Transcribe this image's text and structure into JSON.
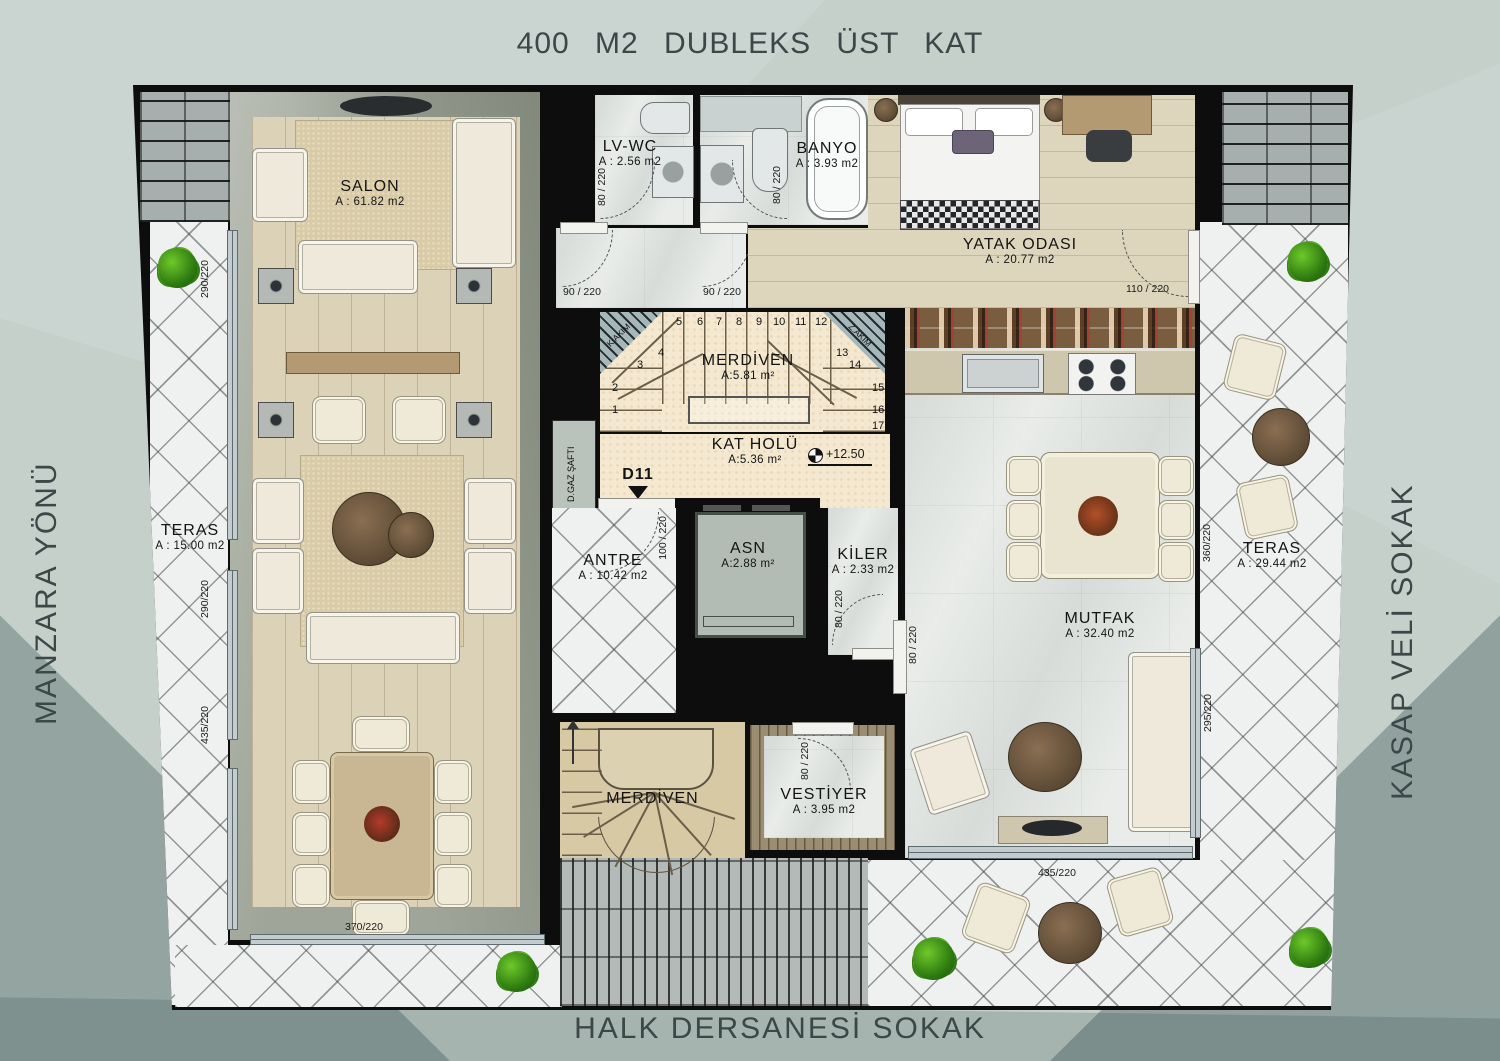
{
  "colors": {
    "wall": "#0d0d0d",
    "background": "#c5d0cb",
    "wood": "#dcd2b8",
    "tile": "#eff1f0",
    "cream": "#f4e9d0",
    "text": "#3c4848"
  },
  "title": "400 M2 DUBLEKS ÜST KAT",
  "streets": {
    "left": "MANZARA YÖNÜ",
    "right": "KASAP VELİ SOKAK",
    "bottom": "HALK DERSANESİ SOKAK"
  },
  "rooms": {
    "salon": {
      "name": "SALON",
      "area": "A : 61.82 m2"
    },
    "lvwc": {
      "name": "LV-WC",
      "area": "A : 2.56 m2"
    },
    "banyo": {
      "name": "BANYO",
      "area": "A : 3.93 m2"
    },
    "yatak_odasi": {
      "name": "YATAK ODASI",
      "area": "A : 20.77 m2"
    },
    "merdiven_ust": {
      "name": "MERDİVEN",
      "area": "A:5.81 m²"
    },
    "kat_holu": {
      "name": "KAT HOLÜ",
      "area": "A:5.36 m²",
      "level": "+12.50"
    },
    "asn": {
      "name": "ASN",
      "area": "A:2.88 m²"
    },
    "antre": {
      "name": "ANTRE",
      "area": "A : 10.42 m2"
    },
    "kiler": {
      "name": "KİLER",
      "area": "A : 2.33 m2"
    },
    "mutfak": {
      "name": "MUTFAK",
      "area": "A : 32.40 m2"
    },
    "teras_bati": {
      "name": "TERAS",
      "area": "A : 15.00 m2"
    },
    "teras_dogu": {
      "name": "TERAS",
      "area": "A : 29.44 m2"
    },
    "merdiven_alt": {
      "name": "MERDİVEN"
    },
    "vestiyer": {
      "name": "VESTİYER",
      "area": "A : 3.95 m2"
    }
  },
  "annotations": {
    "d11": "D11",
    "gaz_safti": "D.GAZ ŞAFTI",
    "k_akim": "K.AKIM",
    "z_akim": "Z.AKIM"
  },
  "dimensions": {
    "salon_window_1": "290/220",
    "salon_window_2": "290/220",
    "salon_window_3": "435/220",
    "salon_window_bottom": "370/220",
    "lvwc_door": "80 / 220",
    "banyo_door": "80 / 220",
    "hol_door_1": "90 / 220",
    "hol_door_2": "90 / 220",
    "yatak_door": "110 / 220",
    "antre_door": "100 / 220",
    "kiler_door": "80 / 220",
    "mutfak_door": "80 / 220",
    "vestiyer_door": "80 / 220",
    "teras_window": "360/220",
    "mutfak_window_side": "295/220",
    "mutfak_window_bottom": "435/220"
  },
  "stairs": {
    "s1": "1",
    "s2": "2",
    "s3": "3",
    "s4": "4",
    "s5": "5",
    "s6": "6",
    "s7": "7",
    "s8": "8",
    "s9": "9",
    "s10": "10",
    "s11": "11",
    "s12": "12",
    "s13": "13",
    "s14": "14",
    "s15": "15",
    "s16": "16",
    "s17": "17"
  }
}
